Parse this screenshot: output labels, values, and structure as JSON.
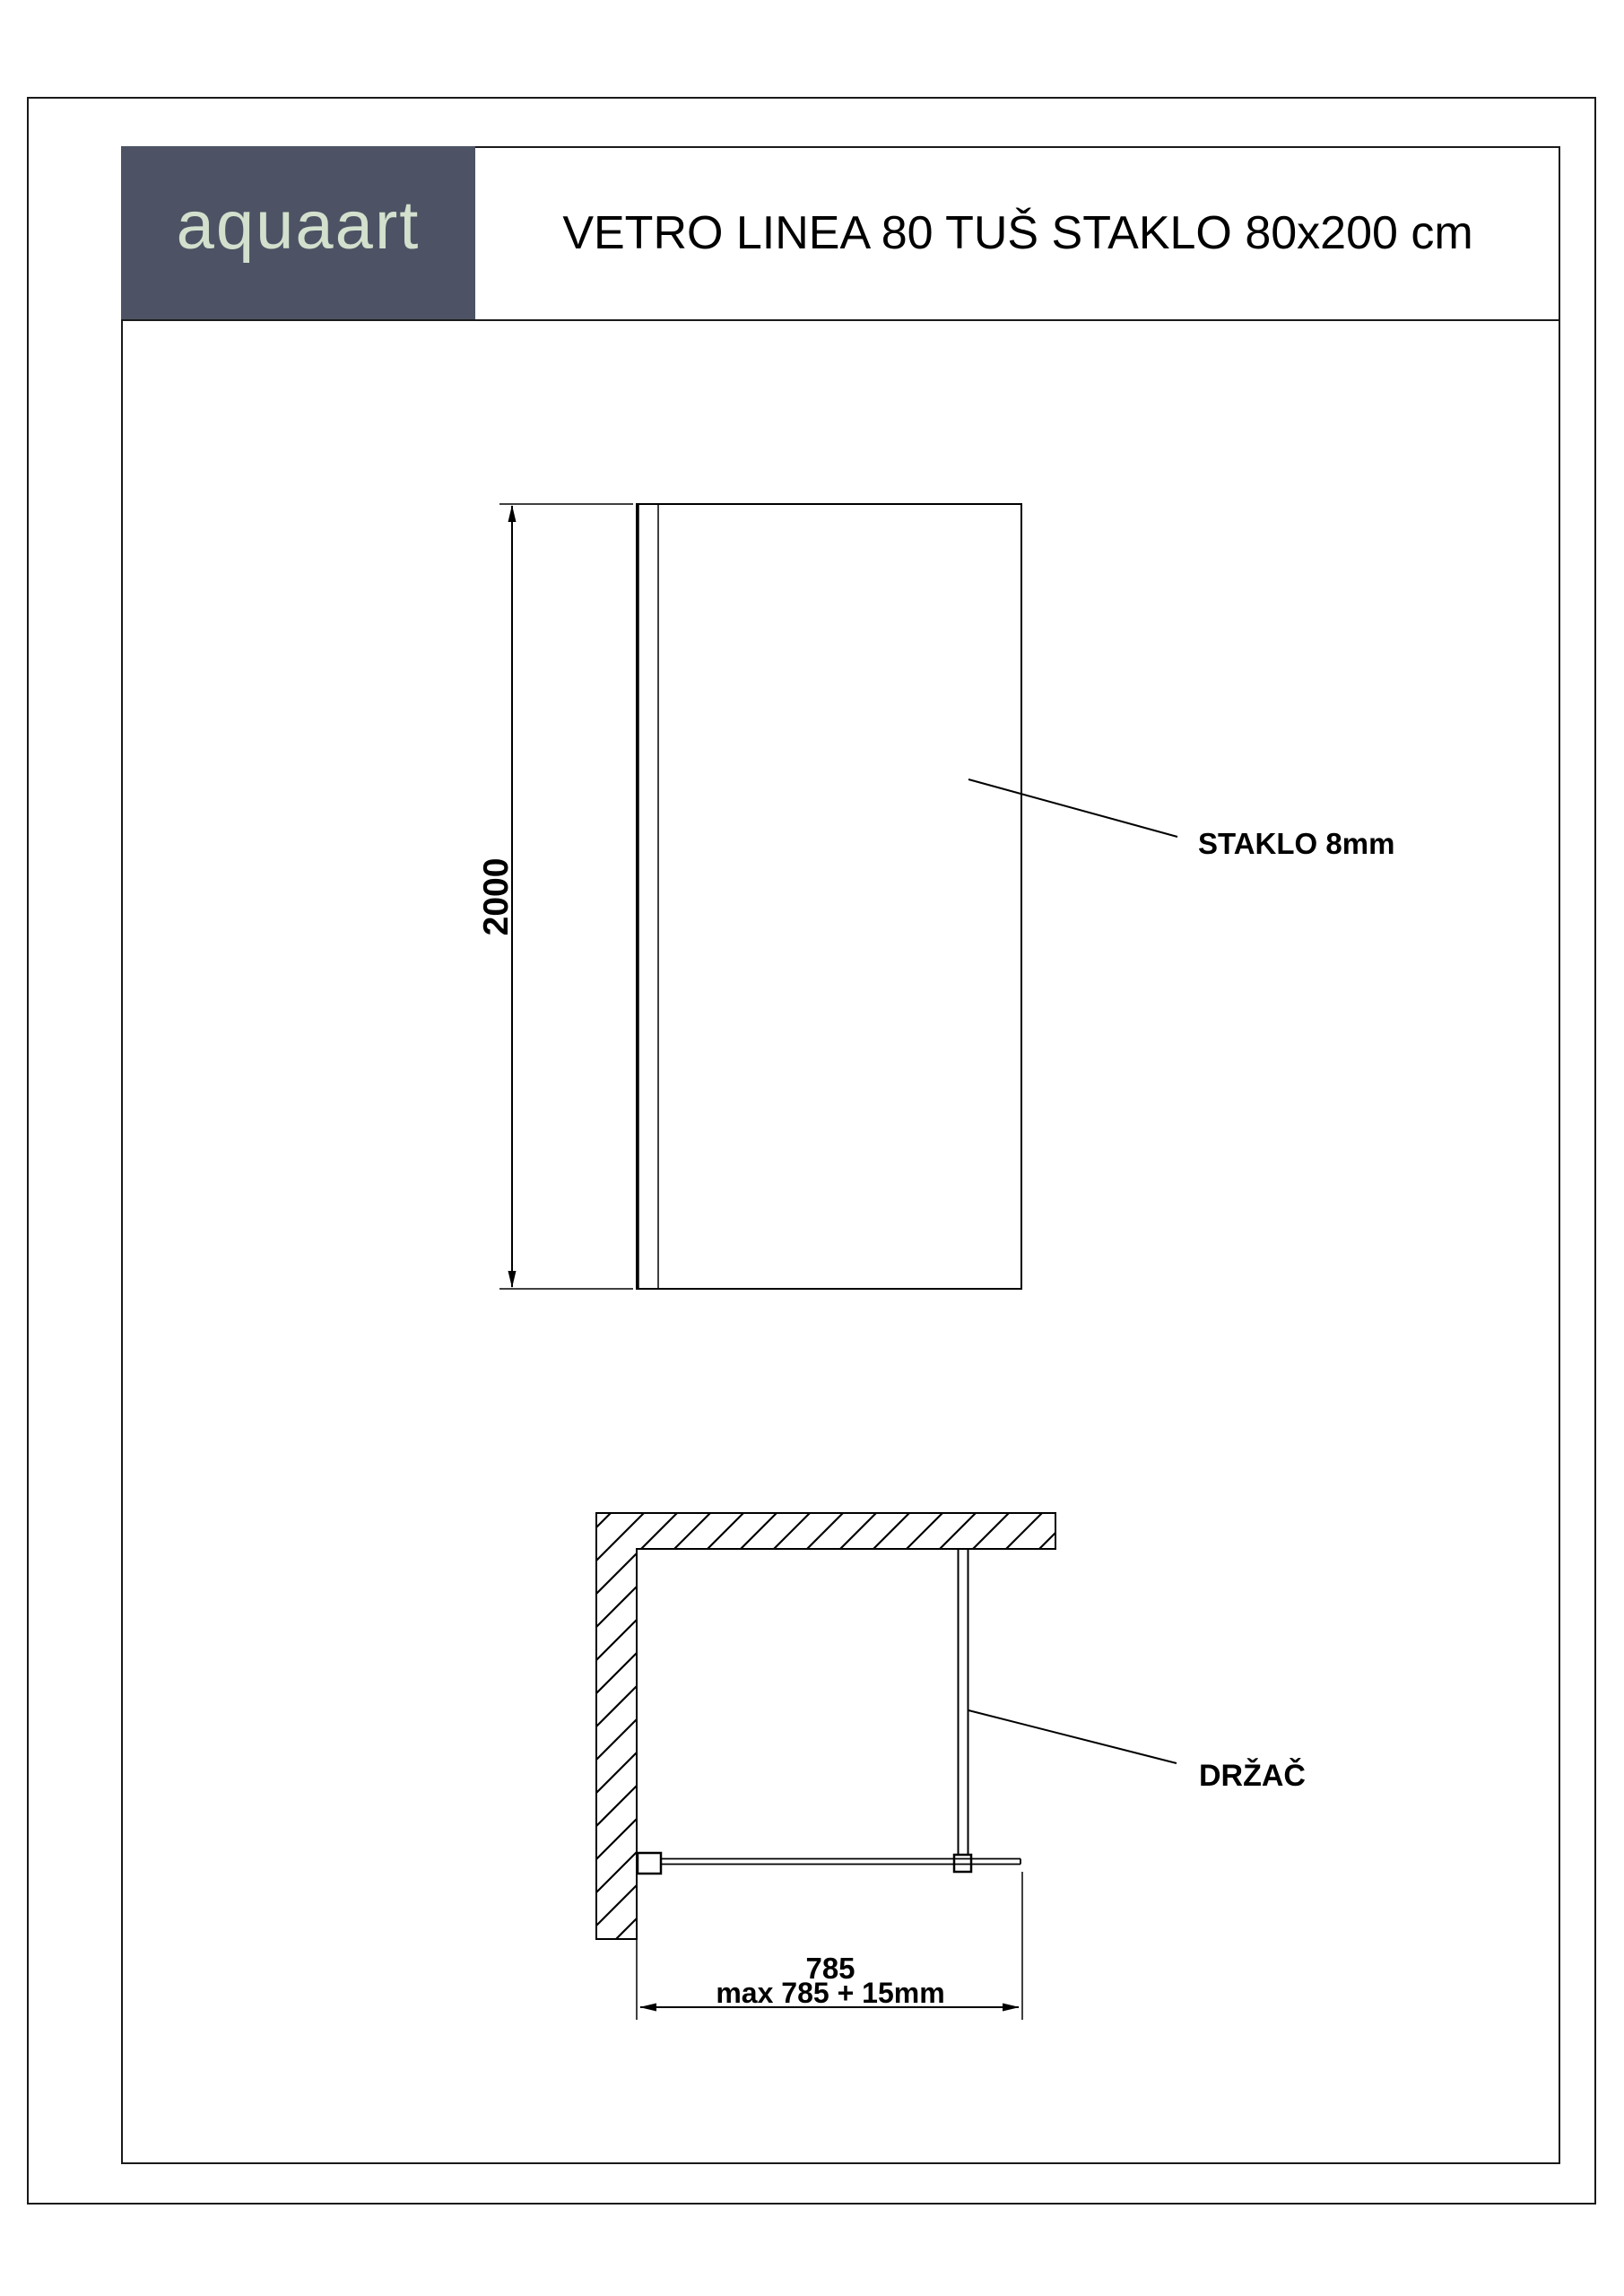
{
  "header": {
    "logo": "aquaart",
    "title": "VETRO LINEA 80 TUŠ STAKLO 80x200 cm"
  },
  "front_view": {
    "height_dimension": "2000",
    "glass_label": "STAKLO 8mm"
  },
  "plan_view": {
    "width_dimension": "785",
    "width_dimension_max": "max 785 + 15mm",
    "holder_label": "DRŽAČ"
  },
  "colors": {
    "header_box": "#4d5364",
    "logo_text": "#d2e0cd",
    "line": "#000000"
  }
}
